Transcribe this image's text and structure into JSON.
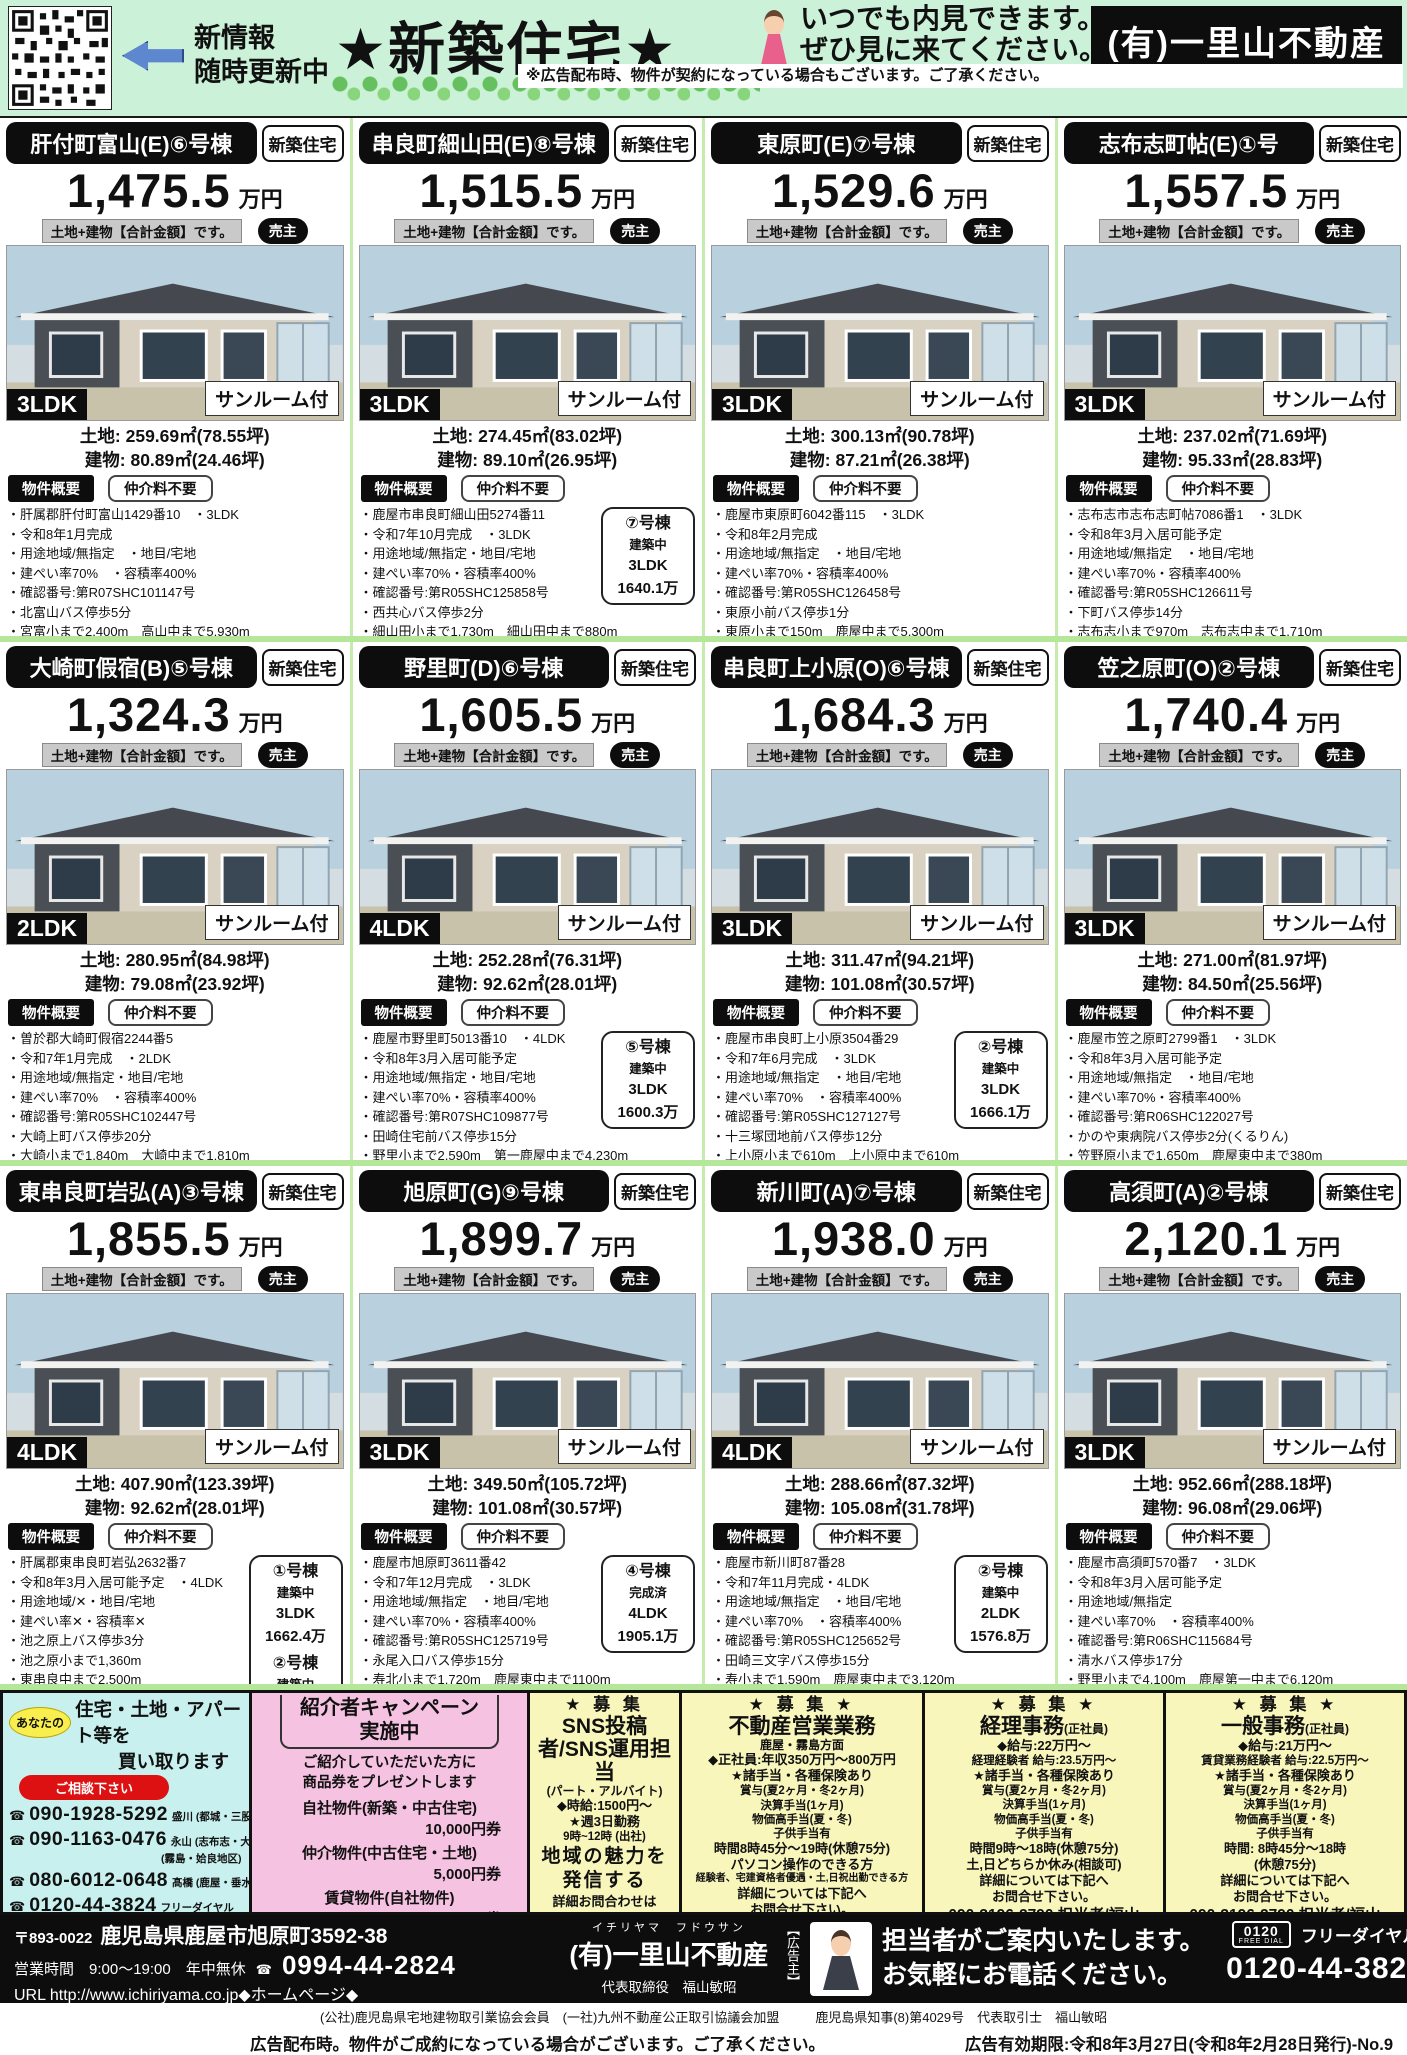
{
  "header": {
    "update_line1": "新情報",
    "update_line2": "随時更新中",
    "title": "★新築住宅★",
    "invite_line1": "いつでも内見できます。",
    "invite_line2": "ぜひ見に来てください。",
    "company": "(有)一里山不動産",
    "disclaimer": "※広告配布時、物件が契約になっている場合もございます。ご了承ください。"
  },
  "icons": {
    "phone": "☎"
  },
  "labels": {
    "new_build": "新築住宅",
    "price_unit": "万円",
    "total_label": "土地+建物【合計金額】です。",
    "seller": "売主",
    "sunroom": "サンルーム付",
    "summary": "物件概要",
    "no_fee": "仲介料不要",
    "land_label": "土地:",
    "building_label": "建物:"
  },
  "properties": [
    {
      "title": "肝付町富山(E)⑥号棟",
      "price": "1,475.5",
      "layout": "3LDK",
      "land": "259.69㎡(78.55坪)",
      "building": "80.89㎡(24.46坪)",
      "details": [
        "肝属郡肝付町富山1429番10　・3LDK",
        "令和8年1月完成",
        "用途地域/無指定　・地目/宅地",
        "建ぺい率70%　・容積率400%",
        "確認番号:第R07SHC101147号",
        "北富山バス停歩5分",
        "宮富小まで2,400m　高山中まで5,930m"
      ],
      "side_boxes": []
    },
    {
      "title": "串良町細山田(E)⑧号棟",
      "price": "1,515.5",
      "layout": "3LDK",
      "land": "274.45㎡(83.02坪)",
      "building": "89.10㎡(26.95坪)",
      "details": [
        "鹿屋市串良町細山田5274番11",
        "令和7年10月完成　・3LDK",
        "用途地域/無指定・地目/宅地",
        "建ぺい率70%・容積率400%",
        "確認番号:第R05SHC125858号",
        "西共心バス停歩2分",
        "細山田小まで1,730m　細山田中まで880m"
      ],
      "side_boxes": [
        {
          "unit": "⑦号棟",
          "status": "建築中",
          "layout": "3LDK",
          "price": "1640.1万"
        }
      ]
    },
    {
      "title": "東原町(E)⑦号棟",
      "price": "1,529.6",
      "layout": "3LDK",
      "land": "300.13㎡(90.78坪)",
      "building": "87.21㎡(26.38坪)",
      "details": [
        "鹿屋市東原町6042番115　・3LDK",
        "令和8年2月完成",
        "用途地域/無指定　・地目/宅地",
        "建ぺい率70%・容積率400%",
        "確認番号:第R05SHC126458号",
        "東原小前バス停歩1分",
        "東原小まで150m　鹿屋中まで5,300m"
      ],
      "side_boxes": []
    },
    {
      "title": "志布志町帖(E)①号",
      "price": "1,557.5",
      "layout": "3LDK",
      "land": "237.02㎡(71.69坪)",
      "building": "95.33㎡(28.83坪)",
      "details": [
        "志布志市志布志町帖7086番1　・3LDK",
        "令和8年3月入居可能予定",
        "用途地域/無指定　・地目/宅地",
        "建ぺい率70%・容積率400%",
        "確認番号:第R05SHC126611号",
        "下町バス停歩14分",
        "志布志小まで970m　志布志中まで1,710m"
      ],
      "side_boxes": []
    },
    {
      "title": "大崎町假宿(B)⑤号棟",
      "price": "1,324.3",
      "layout": "2LDK",
      "land": "280.95㎡(84.98坪)",
      "building": "79.08㎡(23.92坪)",
      "details": [
        "曽於郡大崎町假宿2244番5",
        "令和7年1月完成　・2LDK",
        "用途地域/無指定・地目/宅地",
        "建ぺい率70%　・容積率400%",
        "確認番号:第R05SHC102447号",
        "大崎上町バス停歩20分",
        "大崎小まで1,840m　大崎中まで1,810m"
      ],
      "side_boxes": []
    },
    {
      "title": "野里町(D)⑥号棟",
      "price": "1,605.5",
      "layout": "4LDK",
      "land": "252.28㎡(76.31坪)",
      "building": "92.62㎡(28.01坪)",
      "details": [
        "鹿屋市野里町5013番10　・4LDK",
        "令和8年3月入居可能予定",
        "用途地域/無指定・地目/宅地",
        "建ぺい率70%・容積率400%",
        "確認番号:第R07SHC109877号",
        "田崎住宅前バス停歩15分",
        "野里小まで2,590m　第一鹿屋中まで4,230m"
      ],
      "side_boxes": [
        {
          "unit": "⑤号棟",
          "status": "建築中",
          "layout": "3LDK",
          "price": "1600.3万"
        }
      ]
    },
    {
      "title": "串良町上小原(O)⑥号棟",
      "price": "1,684.3",
      "layout": "3LDK",
      "land": "311.47㎡(94.21坪)",
      "building": "101.08㎡(30.57坪)",
      "details": [
        "鹿屋市串良町上小原3504番29",
        "令和7年6月完成　・3LDK",
        "用途地域/無指定　・地目/宅地",
        "建ぺい率70%　・容積率400%",
        "確認番号:第R05SHC127127号",
        "十三塚団地前バス停歩12分",
        "上小原小まで610m　上小原中まで610m"
      ],
      "side_boxes": [
        {
          "unit": "②号棟",
          "status": "建築中",
          "layout": "3LDK",
          "price": "1666.1万"
        }
      ]
    },
    {
      "title": "笠之原町(O)②号棟",
      "price": "1,740.4",
      "layout": "3LDK",
      "land": "271.00㎡(81.97坪)",
      "building": "84.50㎡(25.56坪)",
      "details": [
        "鹿屋市笠之原町2799番1　・3LDK",
        "令和8年3月入居可能予定",
        "用途地域/無指定　・地目/宅地",
        "建ぺい率70%・容積率400%",
        "確認番号:第R06SHC122027号",
        "かのや東病院バス停歩2分(くるりん)",
        "笠野原小まで1,650m　鹿屋東中まで380m"
      ],
      "side_boxes": []
    },
    {
      "title": "東串良町岩弘(A)③号棟",
      "price": "1,855.5",
      "layout": "4LDK",
      "land": "407.90㎡(123.39坪)",
      "building": "92.62㎡(28.01坪)",
      "details": [
        "肝属郡東串良町岩弘2632番7",
        "令和8年3月入居可能予定　・4LDK",
        "用途地域/✕・地目/宅地",
        "建ぺい率✕・容積率✕",
        "池之原上バス停歩3分",
        "池之原小まで1,360m",
        "東串良中まで2,500m"
      ],
      "side_boxes": [
        {
          "unit": "①号棟",
          "status": "建築中",
          "layout": "3LDK",
          "price": "1662.4万"
        },
        {
          "unit": "②号棟",
          "status": "建築中",
          "layout": "3LDK",
          "price": "1669.1万"
        }
      ]
    },
    {
      "title": "旭原町(G)⑨号棟",
      "price": "1,899.7",
      "layout": "3LDK",
      "land": "349.50㎡(105.72坪)",
      "building": "101.08㎡(30.57坪)",
      "details": [
        "鹿屋市旭原町3611番42",
        "令和7年12月完成　・3LDK",
        "用途地域/無指定　・地目/宅地",
        "建ぺい率70%・容積率400%",
        "確認番号:第R05SHC125719号",
        "永尾入口バス停歩15分",
        "寿北小まで1,720m　鹿屋東中まで1100m"
      ],
      "side_boxes": [
        {
          "unit": "④号棟",
          "status": "完成済",
          "layout": "4LDK",
          "price": "1905.1万"
        }
      ]
    },
    {
      "title": "新川町(A)⑦号棟",
      "price": "1,938.0",
      "layout": "4LDK",
      "land": "288.66㎡(87.32坪)",
      "building": "105.08㎡(31.78坪)",
      "details": [
        "鹿屋市新川町87番28",
        "令和7年11月完成・4LDK",
        "用途地域/無指定　・地目/宅地",
        "建ぺい率70%　・容積率400%",
        "確認番号:第R05SHC125652号",
        "田崎三文字バス停歩15分",
        "寿小まで1,590m　鹿屋東中まで3,120m"
      ],
      "side_boxes": [
        {
          "unit": "②号棟",
          "status": "建築中",
          "layout": "2LDK",
          "price": "1576.8万"
        }
      ]
    },
    {
      "title": "高須町(A)②号棟",
      "price": "2,120.1",
      "layout": "3LDK",
      "land": "952.66㎡(288.18坪)",
      "building": "96.08㎡(29.06坪)",
      "details": [
        "鹿屋市高須町570番7　・3LDK",
        "令和8年3月入居可能予定",
        "用途地域/無指定",
        "建ぺい率70%　・容積率400%",
        "確認番号:第R06SHC115684号",
        "清水バス停歩17分",
        "野里小まで4,100m　鹿屋第一中まで6,120m"
      ],
      "side_boxes": []
    }
  ],
  "buyback": {
    "bubble": "あなたの",
    "title1": "住宅・土地・アパート等を",
    "title2": "買い取ります",
    "consult": "ご相談下さい",
    "phones": [
      {
        "number": "090-1928-5292",
        "region": "盛川 (都城・三股地区)"
      },
      {
        "number": "090-1163-0476",
        "region": "永山 (志布志・大崎地区)",
        "region2": "(霧島・姶良地区)"
      },
      {
        "number": "080-6012-0648",
        "region": "髙橋 (鹿屋・垂水地区)"
      },
      {
        "number": "0120-44-3824",
        "region": "フリーダイヤル"
      }
    ],
    "note1": "＊当社規定により買取りできない場合も",
    "note2": "ありますので、予めご了承ください。"
  },
  "campaign": {
    "title1": "紹介者キャンペーン",
    "title2": "実施中",
    "desc1": "ご紹介していただいた方に",
    "desc2": "商品券をプレゼントします",
    "items": [
      {
        "label": "自社物件(新築・中古住宅)",
        "value": "10,000円券"
      },
      {
        "label": "仲介物件(中古住宅・土地)",
        "value": "5,000円券"
      },
      {
        "label": "賃貸物件(自社物件)",
        "value": "2,000円券"
      }
    ]
  },
  "jobs": [
    {
      "header": "★ 募 集",
      "title": "SNS投稿者/SNS運用担当",
      "suffix": "",
      "subtitle": "(パート・アルバイト)",
      "lines": [
        {
          "t": "◆時給:1500円〜",
          "c": "md"
        },
        {
          "t": "★週3日勤務",
          "c": "md"
        },
        {
          "t": "9時~12時 (出社)",
          "c": ""
        },
        {
          "t": "地域の魅力を",
          "c": "lg"
        },
        {
          "t": "発信する",
          "c": "lg"
        },
        {
          "t": "詳細お問合わせは",
          "c": "md"
        },
        {
          "t": "090-3196-2790",
          "c": "num"
        },
        {
          "t": "担当者/福山",
          "c": ""
        }
      ]
    },
    {
      "header": "★ 募 集 ★",
      "title": "不動産営業業務",
      "suffix": "",
      "subtitle": "鹿屋・霧島方面",
      "lines": [
        {
          "t": "◆正社員:年収350万円〜800万円",
          "c": "md"
        },
        {
          "t": "★諸手当・各種保険あり",
          "c": "md"
        },
        {
          "t": "賞与(夏2ヶ月・冬2ヶ月)",
          "c": ""
        },
        {
          "t": "決算手当(1ヶ月)",
          "c": ""
        },
        {
          "t": "物価高手当(夏・冬)",
          "c": ""
        },
        {
          "t": "子供手当有",
          "c": ""
        },
        {
          "t": "時間8時45分〜19時(休憩75分)",
          "c": "md"
        },
        {
          "t": "パソコン操作のできる方",
          "c": "md"
        },
        {
          "t": "経験者、宅建資格者優遇・土,日祝出勤できる方",
          "c": "sm"
        },
        {
          "t": "詳細については下記へ",
          "c": "md"
        },
        {
          "t": "お問合せ下さい。",
          "c": "md"
        },
        {
          "t": "090-3196-2790 担当者/福山",
          "c": "num"
        }
      ]
    },
    {
      "header": "★ 募 集 ★",
      "title": "経理事務",
      "suffix": "(正社員)",
      "subtitle": "",
      "lines": [
        {
          "t": "◆給与:22万円〜",
          "c": "md"
        },
        {
          "t": "経理経験者 給与:23.5万円〜",
          "c": ""
        },
        {
          "t": "★諸手当・各種保険あり",
          "c": "md"
        },
        {
          "t": "賞与(夏2ヶ月・冬2ヶ月)",
          "c": ""
        },
        {
          "t": "決算手当(1ヶ月)",
          "c": ""
        },
        {
          "t": "物価高手当(夏・冬)",
          "c": ""
        },
        {
          "t": "子供手当有",
          "c": ""
        },
        {
          "t": "時間9時〜18時(休憩75分)",
          "c": "md"
        },
        {
          "t": "土,日どちらか休み(相談可)",
          "c": "md"
        },
        {
          "t": "詳細については下記へ",
          "c": "md"
        },
        {
          "t": "お問合せ下さい。",
          "c": "md"
        },
        {
          "t": "090-3196-2790 担当者/福山",
          "c": "num"
        }
      ]
    },
    {
      "header": "★ 募 集 ★",
      "title": "一般事務",
      "suffix": "(正社員)",
      "subtitle": "",
      "lines": [
        {
          "t": "◆給与:21万円〜",
          "c": "md"
        },
        {
          "t": "賃貸業務経験者 給与:22.5万円〜",
          "c": ""
        },
        {
          "t": "★諸手当・各種保険あり",
          "c": "md"
        },
        {
          "t": "賞与(夏2ヶ月・冬2ヶ月)",
          "c": ""
        },
        {
          "t": "決算手当(1ヶ月)",
          "c": ""
        },
        {
          "t": "物価高手当(夏・冬)",
          "c": ""
        },
        {
          "t": "子供手当有",
          "c": ""
        },
        {
          "t": "時間: 8時45分〜18時",
          "c": "md"
        },
        {
          "t": "(休憩75分)",
          "c": "md"
        },
        {
          "t": "詳細については下記へ",
          "c": "md"
        },
        {
          "t": "お問合せ下さい。",
          "c": "md"
        },
        {
          "t": "090-3196-2790 担当者/福山",
          "c": "num"
        }
      ]
    }
  ],
  "footer": {
    "postal": "〒893-0022",
    "address": "鹿児島県鹿屋市旭原町3592-38",
    "hours": "営業時間　9:00〜19:00　年中無休",
    "phone": "0994-44-2824",
    "url": "URL http://www.ichiriyama.co.jp◆ホームページ◆",
    "furigana": "イチリヤマ　フドウサン",
    "company": "(有)一里山不動産",
    "ceo": "代表取締役　福山敏昭",
    "sponsor": "【広告主】",
    "guide1": "担当者がご案内いたします。",
    "guide2": "お気軽にお電話ください。",
    "freedial_logo_top": "0120",
    "freedial_logo_bottom": "FREE DIAL",
    "freedial_label": "フリーダイヤル",
    "freedial_number": "0120-44-3824",
    "association": "(公社)鹿児島県宅地建物取引業協会会員　(一社)九州不動産公正取引協議会加盟",
    "license": "鹿児島県知事(8)第4029号　代表取引士　福山敏昭",
    "note": "広告配布時。物件がご成約になっている場合がございます。ご了承ください。",
    "validity": "広告有効期限:令和8年3月27日(令和8年2月28日発行)-No.9"
  }
}
